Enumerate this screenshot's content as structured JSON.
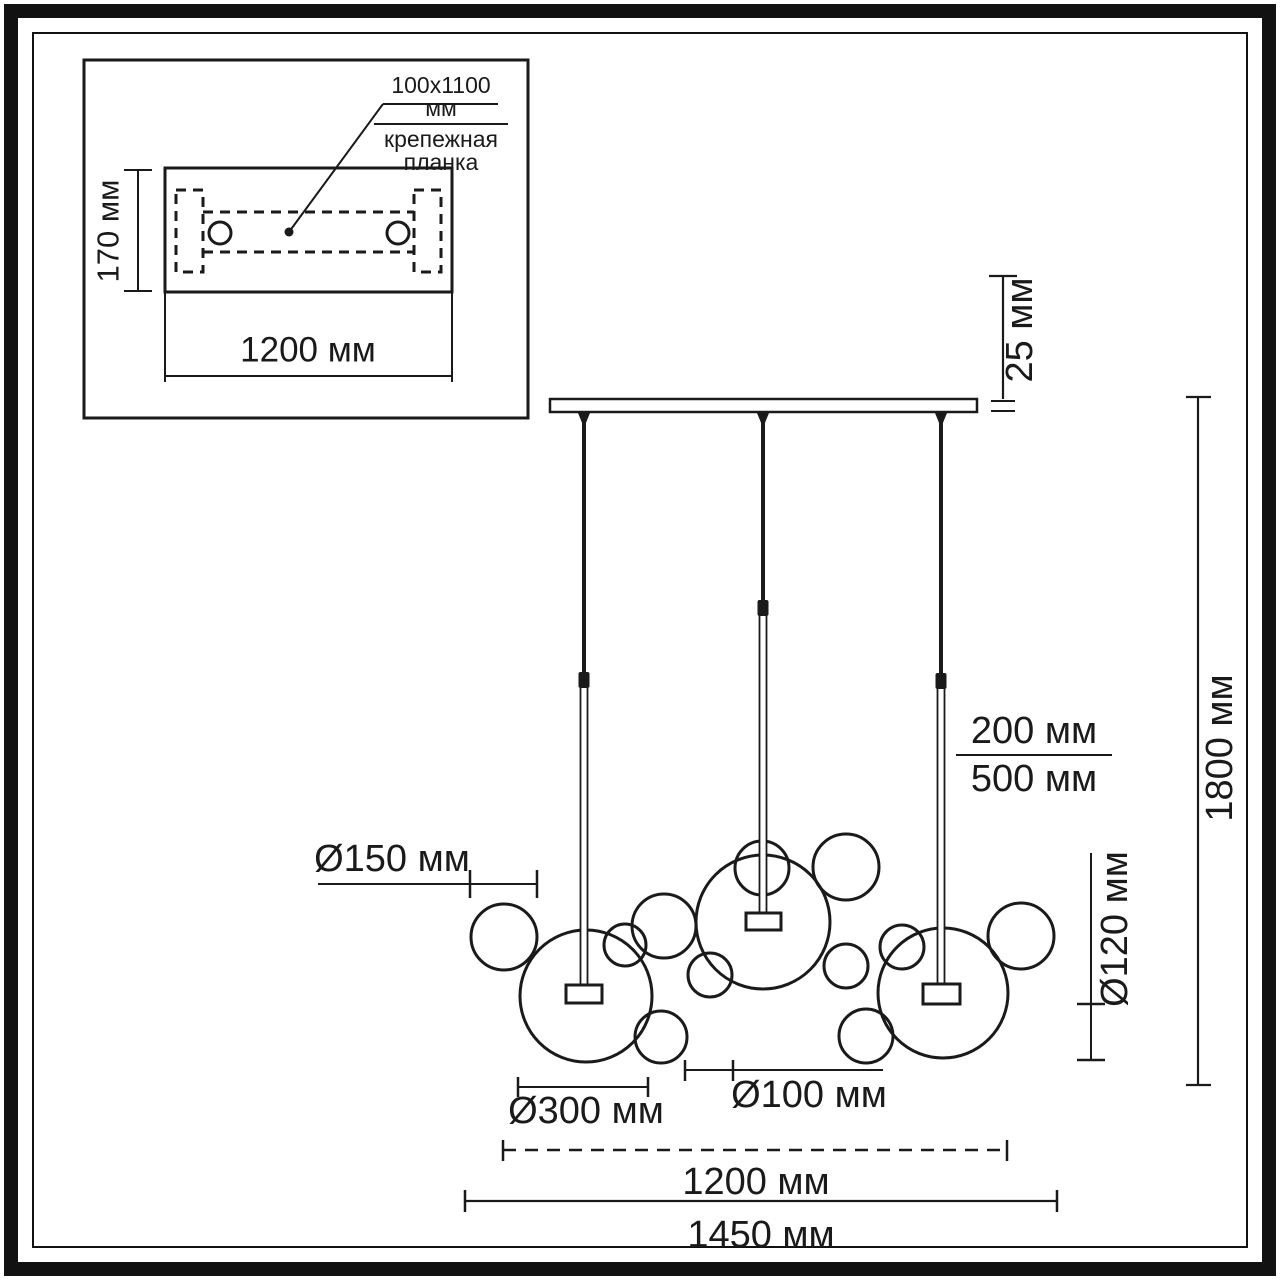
{
  "colors": {
    "ink": "#1a1a1a",
    "paper": "#ffffff"
  },
  "inset": {
    "callout_size": "100x1100 мм",
    "callout_name_line1": "крепежная",
    "callout_name_line2": "планка",
    "height_label": "170 мм",
    "width_label": "1200 мм"
  },
  "dimensions": {
    "canopy_thickness": "25 мм",
    "overall_height": "1800 мм",
    "cord_upper": "200 мм",
    "cord_lower": "500 мм",
    "bubble_150": "Ø150 мм",
    "bubble_120": "Ø120 мм",
    "bubble_300": "Ø300 мм",
    "bubble_100": "Ø100 мм",
    "canopy_width": "1200 мм",
    "overall_width": "1450 мм"
  },
  "drawing": {
    "stroke": "#1a1a1a",
    "inset_box": {
      "x": 84,
      "y": 60,
      "w": 444,
      "h": 358
    },
    "plate": {
      "x": 165,
      "y": 168,
      "w": 287,
      "h": 124
    },
    "dashed_rects": [
      {
        "x": 176,
        "y": 190,
        "w": 27,
        "h": 82
      },
      {
        "x": 414,
        "y": 190,
        "w": 27,
        "h": 82
      }
    ],
    "holes": [
      {
        "cx": 220,
        "cy": 233,
        "r": 11
      },
      {
        "cx": 398,
        "cy": 233,
        "r": 11
      }
    ],
    "dot": {
      "cx": 289,
      "cy": 232,
      "r": 4.5
    },
    "bar": {
      "x": 550,
      "y": 399,
      "w": 427,
      "h": 13
    },
    "rods": [
      {
        "x": 584,
        "cable_end": 672,
        "conn_end": 688,
        "socket": {
          "x": 566,
          "y": 985,
          "w": 36,
          "h": 18
        }
      },
      {
        "x": 763,
        "cable_end": 600,
        "conn_end": 616,
        "socket": {
          "x": 746,
          "y": 913,
          "w": 35,
          "h": 17
        }
      },
      {
        "x": 941,
        "cable_end": 673,
        "conn_end": 689,
        "socket": {
          "x": 923,
          "y": 984,
          "w": 37,
          "h": 20
        }
      }
    ],
    "bubbles": [
      {
        "cx": 586,
        "cy": 996,
        "r": 66
      },
      {
        "cx": 504,
        "cy": 937,
        "r": 33
      },
      {
        "cx": 625,
        "cy": 945,
        "r": 21
      },
      {
        "cx": 664,
        "cy": 926,
        "r": 32
      },
      {
        "cx": 661,
        "cy": 1037,
        "r": 26
      },
      {
        "cx": 763,
        "cy": 922,
        "r": 67
      },
      {
        "cx": 762,
        "cy": 868,
        "r": 27
      },
      {
        "cx": 846,
        "cy": 867,
        "r": 33
      },
      {
        "cx": 846,
        "cy": 966,
        "r": 22
      },
      {
        "cx": 710,
        "cy": 975,
        "r": 22
      },
      {
        "cx": 866,
        "cy": 1036,
        "r": 27
      },
      {
        "cx": 943,
        "cy": 993,
        "r": 65
      },
      {
        "cx": 902,
        "cy": 947,
        "r": 22
      },
      {
        "cx": 1021,
        "cy": 936,
        "r": 33
      }
    ],
    "lines": [
      {
        "x1": 1003,
        "y1": 276,
        "x2": 1003,
        "y2": 399,
        "w": 2.2
      },
      {
        "x1": 989,
        "y1": 276,
        "x2": 1017,
        "y2": 276,
        "w": 2.2
      },
      {
        "x1": 991,
        "y1": 401,
        "x2": 1015,
        "y2": 401,
        "w": 2
      },
      {
        "x1": 991,
        "y1": 411,
        "x2": 1015,
        "y2": 411,
        "w": 2
      },
      {
        "x1": 1198,
        "y1": 397,
        "x2": 1198,
        "y2": 1085,
        "w": 2.2
      },
      {
        "x1": 1186,
        "y1": 397,
        "x2": 1211,
        "y2": 397,
        "w": 2.2
      },
      {
        "x1": 1186,
        "y1": 1085,
        "x2": 1211,
        "y2": 1085,
        "w": 2.2
      },
      {
        "x1": 318,
        "y1": 884,
        "x2": 537,
        "y2": 884,
        "w": 2
      },
      {
        "x1": 470,
        "y1": 870,
        "x2": 470,
        "y2": 898,
        "w": 2.5
      },
      {
        "x1": 537,
        "y1": 870,
        "x2": 537,
        "y2": 898,
        "w": 2.5
      },
      {
        "x1": 1091,
        "y1": 853,
        "x2": 1091,
        "y2": 1060,
        "w": 2
      },
      {
        "x1": 1077,
        "y1": 1004,
        "x2": 1105,
        "y2": 1004,
        "w": 2.5
      },
      {
        "x1": 1077,
        "y1": 1060,
        "x2": 1105,
        "y2": 1060,
        "w": 2.5
      },
      {
        "x1": 518,
        "y1": 1087,
        "x2": 648,
        "y2": 1087,
        "w": 2
      },
      {
        "x1": 518,
        "y1": 1077,
        "x2": 518,
        "y2": 1097,
        "w": 2.5
      },
      {
        "x1": 648,
        "y1": 1077,
        "x2": 648,
        "y2": 1097,
        "w": 2.5
      },
      {
        "x1": 685,
        "y1": 1070,
        "x2": 883,
        "y2": 1070,
        "w": 2
      },
      {
        "x1": 685,
        "y1": 1060,
        "x2": 685,
        "y2": 1081,
        "w": 2.5
      },
      {
        "x1": 733,
        "y1": 1060,
        "x2": 733,
        "y2": 1081,
        "w": 2.5
      },
      {
        "x1": 503,
        "y1": 1150,
        "x2": 1007,
        "y2": 1150,
        "w": 2.5,
        "dash": "13,9"
      },
      {
        "x1": 503,
        "y1": 1140,
        "x2": 503,
        "y2": 1161,
        "w": 2.5
      },
      {
        "x1": 1007,
        "y1": 1140,
        "x2": 1007,
        "y2": 1161,
        "w": 2.5
      },
      {
        "x1": 465,
        "y1": 1201,
        "x2": 1057,
        "y2": 1201,
        "w": 2.2
      },
      {
        "x1": 465,
        "y1": 1190,
        "x2": 465,
        "y2": 1212,
        "w": 2.5
      },
      {
        "x1": 1057,
        "y1": 1190,
        "x2": 1057,
        "y2": 1212,
        "w": 2.5
      },
      {
        "x1": 138,
        "y1": 170,
        "x2": 138,
        "y2": 291,
        "w": 2
      },
      {
        "x1": 124,
        "y1": 170,
        "x2": 152,
        "y2": 170,
        "w": 2
      },
      {
        "x1": 124,
        "y1": 291,
        "x2": 152,
        "y2": 291,
        "w": 2
      },
      {
        "x1": 165,
        "y1": 292,
        "x2": 165,
        "y2": 382,
        "w": 2
      },
      {
        "x1": 452,
        "y1": 292,
        "x2": 452,
        "y2": 382,
        "w": 2
      },
      {
        "x1": 165,
        "y1": 376,
        "x2": 452,
        "y2": 376,
        "w": 2
      },
      {
        "x1": 289,
        "y1": 232,
        "x2": 383,
        "y2": 104,
        "w": 2
      },
      {
        "x1": 383,
        "y1": 104,
        "x2": 498,
        "y2": 104,
        "w": 2
      },
      {
        "x1": 203,
        "y1": 212,
        "x2": 414,
        "y2": 212,
        "w": 3,
        "dash": "10,7"
      },
      {
        "x1": 203,
        "y1": 252,
        "x2": 414,
        "y2": 252,
        "w": 3,
        "dash": "10,7"
      }
    ]
  }
}
